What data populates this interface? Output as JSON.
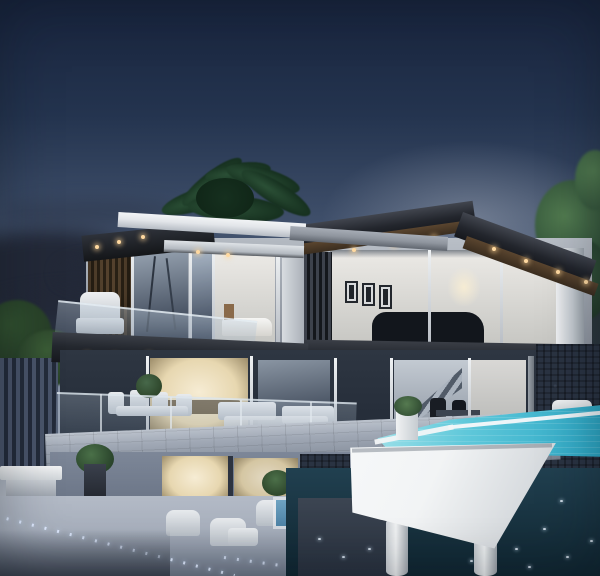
{
  "meta": {
    "type": "photograph",
    "subject": "Modern two-storey luxury villa at dusk",
    "setting": "hillside terrace over water",
    "time_of_day": "dusk"
  },
  "scene": {
    "left_volume": "glass-corner bedroom with balcony, white roof fascia and wood slat wall",
    "right_volume": "dark flat-roof volume with glass living room, three framed artworks and a dark car inside",
    "features": [
      "flat roofs with recessed warm soffit lights",
      "floor-to-ceiling glazing with lit interiors",
      "stone feature walls",
      "cantilevered white infinity pool on round pillars",
      "LED path marker lights in the lower terrace",
      "outdoor lounge and dining furniture",
      "palm tree behind the left roof",
      "green trees at the right edge"
    ],
    "artwork_frames": 3,
    "pool_pillars": 2,
    "roof_light_count": 12
  },
  "colors": {
    "sky_top": "#18243d",
    "sky_mid": "#44546f",
    "sky_low": "#8b96a8",
    "horizon": "#c3c7cd",
    "cloud": "#232938",
    "palm_dark": "#16301f",
    "palm_mid": "#2b5036",
    "tree_green": "#33533a",
    "tree_light": "#527c50",
    "bush_dark": "#223524",
    "roof_white": "#e2e5e9",
    "roof_white_shade": "#b6bcc4",
    "roof_gray": "#8f959e",
    "roof_gray_dark": "#60666f",
    "charcoal": "#23262d",
    "charcoal_light": "#41454e",
    "soffit_dark": "#141619",
    "soffit_wood": "#5a452f",
    "soffit_wood_dark": "#3a2d1f",
    "wood_slat": "#57442f",
    "wood_slat_dark": "#2b2216",
    "glass_cool": "#9aa6b4",
    "glass_deep": "#2c3647",
    "interior_white": "#eceae6",
    "interior_shade": "#c7c7c3",
    "interior_warm": "#e7d7b0",
    "interior_warm_core": "#f6ecd4",
    "frame_white": "#e8ebee",
    "slab_dark": "#24282f",
    "stone_wall": "#3e4857",
    "stone_wall_dark": "#2a3342",
    "terrace_stone": "#a0a8b5",
    "terrace_stone_dark": "#79828f",
    "pool_light": "#abe6ec",
    "pool_mid": "#5fc8da",
    "pool_deep": "#2aa6c4",
    "basin_white": "#f2f4f5",
    "basin_shade": "#c7ccd1",
    "sea": "#214050",
    "sea_deep": "#102631",
    "paving": "#a9b1be",
    "paving_dark": "#6e7889",
    "light_warm": "#ffd9a0",
    "led": "#dfeaff",
    "pond": "#4e83a6",
    "car": "#12161c",
    "fence": "#49546a",
    "white": "#f4f5f6"
  }
}
